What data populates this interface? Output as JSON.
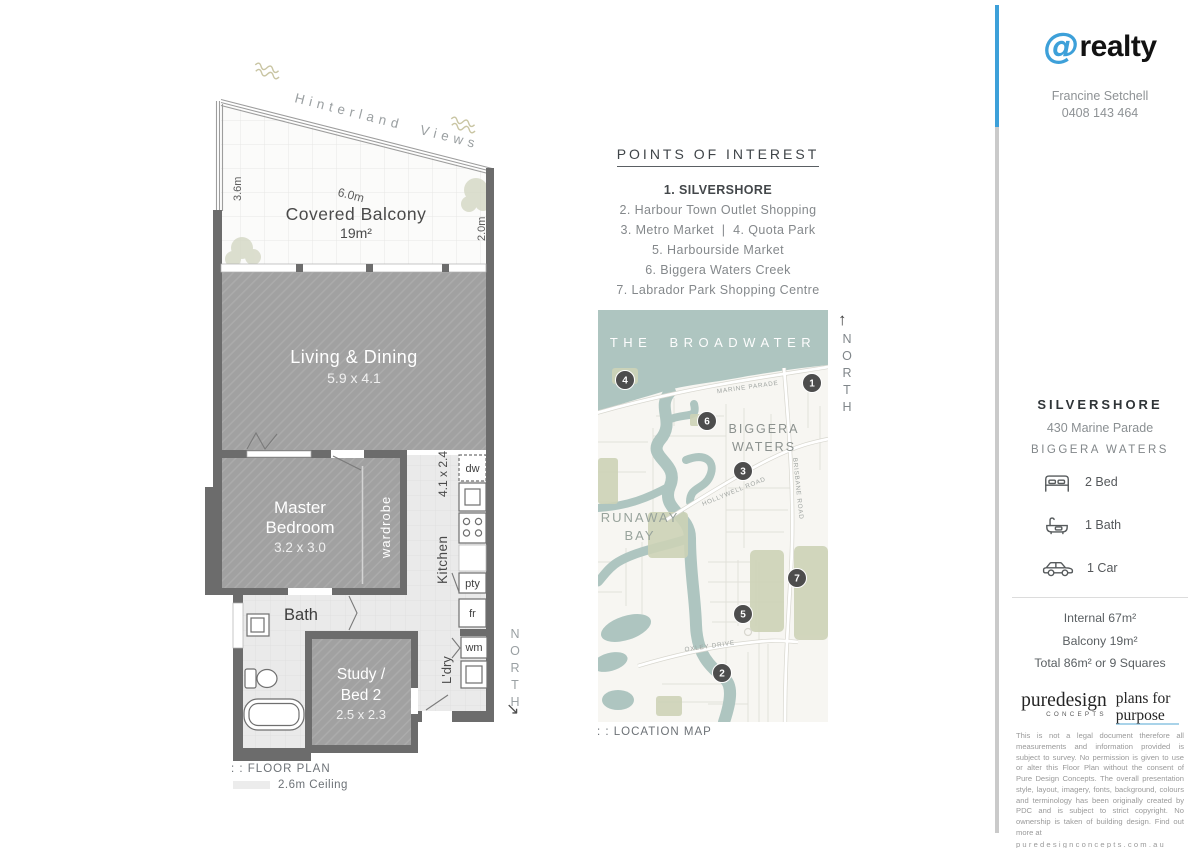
{
  "branding": {
    "at_symbol": "@",
    "name": "realty",
    "agent": "Francine Setchell",
    "phone": "0408 143 464",
    "accent_color": "#3da0d9"
  },
  "poi": {
    "title": "POINTS OF INTEREST",
    "items": [
      "1. SILVERSHORE",
      "2. Harbour Town Outlet Shopping",
      "3. Metro Market  |  4. Quota Park",
      "5. Harbourside Market",
      "6. Biggera Waters Creek",
      "7. Labrador Park Shopping Centre"
    ]
  },
  "map": {
    "caption": ": : LOCATION MAP",
    "north_label": "NORTH",
    "north_arrow": "↑",
    "water_label": "THE BROADWATER",
    "labels": {
      "biggera1": "BIGGERA",
      "biggera2": "WATERS",
      "runaway1": "RUNAWAY",
      "runaway2": "BAY",
      "marine": "MARINE PARADE",
      "hollywell": "HOLLYWELL ROAD",
      "brisbane": "BRISBANE ROAD",
      "oxley": "OXLEY DRIVE"
    },
    "markers": [
      "1",
      "2",
      "3",
      "4",
      "5",
      "6",
      "7"
    ],
    "water_color": "#aec5c0",
    "park_color": "#cdd3b7"
  },
  "floorplan": {
    "view_label": "Hinterland Views",
    "north_label": "NORTH",
    "north_arrow": "↘",
    "caption": ": : FLOOR PLAN",
    "ceiling": "2.6m Ceiling",
    "wall_color": "#6c6c6c",
    "balcony": {
      "name": "Covered Balcony",
      "area": "19m²",
      "dim_top": "6.0m",
      "dim_left": "3.6m",
      "dim_right": "2.0m"
    },
    "living": {
      "name": "Living & Dining",
      "size": "5.9 x 4.1"
    },
    "master": {
      "line1": "Master",
      "line2": "Bedroom",
      "size": "3.2 x 3.0"
    },
    "wardrobe": "wardrobe",
    "kitchen": {
      "name": "Kitchen",
      "size": "4.1 x 2.4"
    },
    "bath": "Bath",
    "study": {
      "line1": "Study /",
      "line2": "Bed 2",
      "size": "2.5 x 2.3"
    },
    "laundry": "L'dry",
    "appliances": {
      "dw": "dw",
      "pty": "pty",
      "fr": "fr",
      "wm": "wm"
    }
  },
  "property": {
    "name": "SILVERSHORE",
    "address": "430 Marine Parade",
    "suburb": "BIGGERA WATERS",
    "features": [
      {
        "icon": "bed-icon",
        "label": "2 Bed"
      },
      {
        "icon": "bath-icon",
        "label": "1 Bath"
      },
      {
        "icon": "car-icon",
        "label": "1 Car"
      }
    ],
    "areas": [
      "Internal 67m²",
      "Balcony 19m²",
      "Total 86m² or 9 Squares"
    ]
  },
  "designer": {
    "name": "puredesign",
    "sub": "CONCEPTS",
    "tag1": "plans for",
    "tag2": "purpose",
    "disclaimer": "This is not a legal document therefore all measurements and information provided is subject to survey. No permission is given to use or alter this Floor Plan without the consent of Pure Design Concepts. The overall presentation style, layout, imagery, fonts, background, colours and terminology has been originally created by PDC and is subject to strict copyright. No ownership is taken of building design. Find out more at",
    "url": "puredesignconcepts.com.au"
  }
}
